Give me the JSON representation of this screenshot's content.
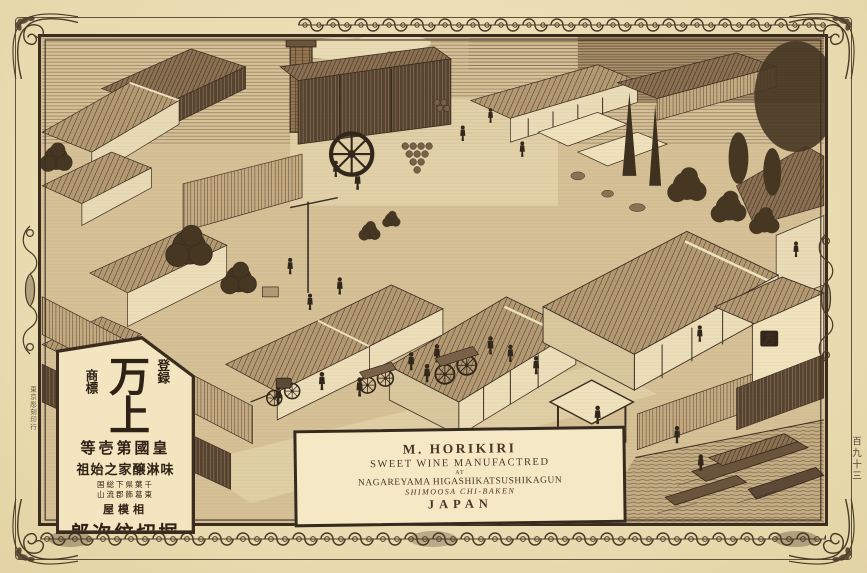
{
  "colors": {
    "paper": "#ecdfb6",
    "ground": "#d6c096",
    "ink": "#3a2d20",
    "panel_bg": "#f2e5bf",
    "label_bg": "#f4e8c5"
  },
  "margins": {
    "printer_credit": "東京彫刻印行",
    "page_number": "百九十三"
  },
  "label_box": {
    "name": "M. HORIKIRI",
    "line_product": "SWEET WINE MANUFACTRED",
    "line_at": "AT",
    "line_address1": "NAGAREYAMA HIGASHIKATSUSHIKAGUN",
    "line_address2": "SHIMOOSA CHI-BAKEN",
    "line_country": "JAPAN"
  },
  "trademark_panel": {
    "col_right": "登録",
    "col_left": "商標",
    "brand": "万上",
    "row_rank": "等壱第國皇",
    "row_originator": "祖始之家醸淋味",
    "row_address_top": "国総下県葉千",
    "row_address_bottom": "山流郡飾葛東",
    "row_shop": "屋模相",
    "row_proprietor": "郎次紋切堀"
  },
  "illustration": {
    "warehouse_mark": "万"
  }
}
